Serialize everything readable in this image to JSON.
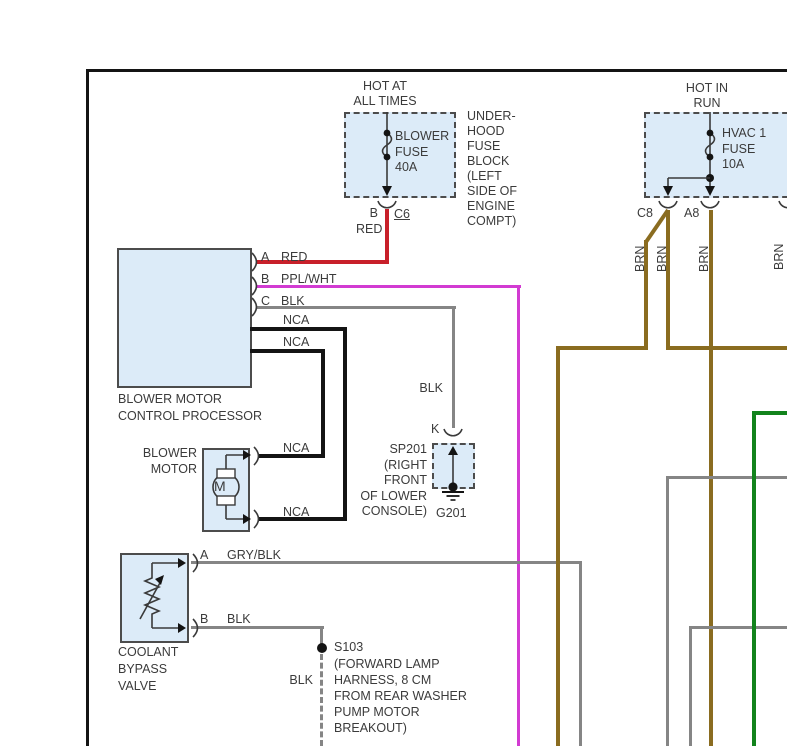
{
  "colors": {
    "red": "#c8202a",
    "ppl_wht": "#d23bd2",
    "gray": "#858585",
    "black": "#141414",
    "brn": "#8a6c20",
    "green": "#12831c",
    "box_fill": "#dcebf8",
    "box_border": "#4c4c4c"
  },
  "left_power": {
    "header": [
      "HOT AT",
      "ALL TIMES"
    ],
    "fuse_label": [
      "BLOWER",
      "FUSE",
      "40A"
    ],
    "pin_label": "B",
    "connector_label": "C6",
    "wire_label": "RED",
    "location_note": [
      "UNDER-",
      "HOOD",
      "FUSE",
      "BLOCK",
      "(LEFT",
      "SIDE OF",
      "ENGINE",
      "COMPT)"
    ]
  },
  "right_power": {
    "header": [
      "HOT IN",
      "RUN"
    ],
    "fuse_label": [
      "HVAC 1",
      "FUSE",
      "10A"
    ],
    "connector_left": "C8",
    "connector_right": "A8",
    "wire_labels": [
      "BRN",
      "BRN",
      "BRN",
      "BRN"
    ]
  },
  "processor": {
    "name": [
      "BLOWER MOTOR",
      "CONTROL PROCESSOR"
    ],
    "pins": [
      {
        "pin": "A",
        "wire": "RED"
      },
      {
        "pin": "B",
        "wire": "PPL/WHT"
      },
      {
        "pin": "C",
        "wire": "BLK"
      },
      {
        "pin": "",
        "wire": "NCA"
      },
      {
        "pin": "",
        "wire": "NCA"
      }
    ]
  },
  "blower_motor": {
    "name": [
      "BLOWER",
      "MOTOR"
    ],
    "symbol": "M",
    "wire_labels": [
      "NCA",
      "NCA"
    ]
  },
  "sp201": {
    "wire_label": "BLK",
    "pin": "K",
    "label_lines": [
      "SP201",
      "(RIGHT",
      "FRONT",
      "OF LOWER",
      "CONSOLE)"
    ],
    "ground_name": "G201"
  },
  "coolant_valve": {
    "name": [
      "COOLANT",
      "BYPASS",
      "VALVE"
    ],
    "pins": [
      {
        "pin": "A",
        "wire": "GRY/BLK"
      },
      {
        "pin": "B",
        "wire": "BLK"
      }
    ]
  },
  "s103": {
    "name": "S103",
    "wire_label": "BLK",
    "note": [
      "(FORWARD LAMP",
      "HARNESS, 8 CM",
      "FROM REAR WASHER",
      "PUMP MOTOR",
      "BREAKOUT)"
    ]
  }
}
